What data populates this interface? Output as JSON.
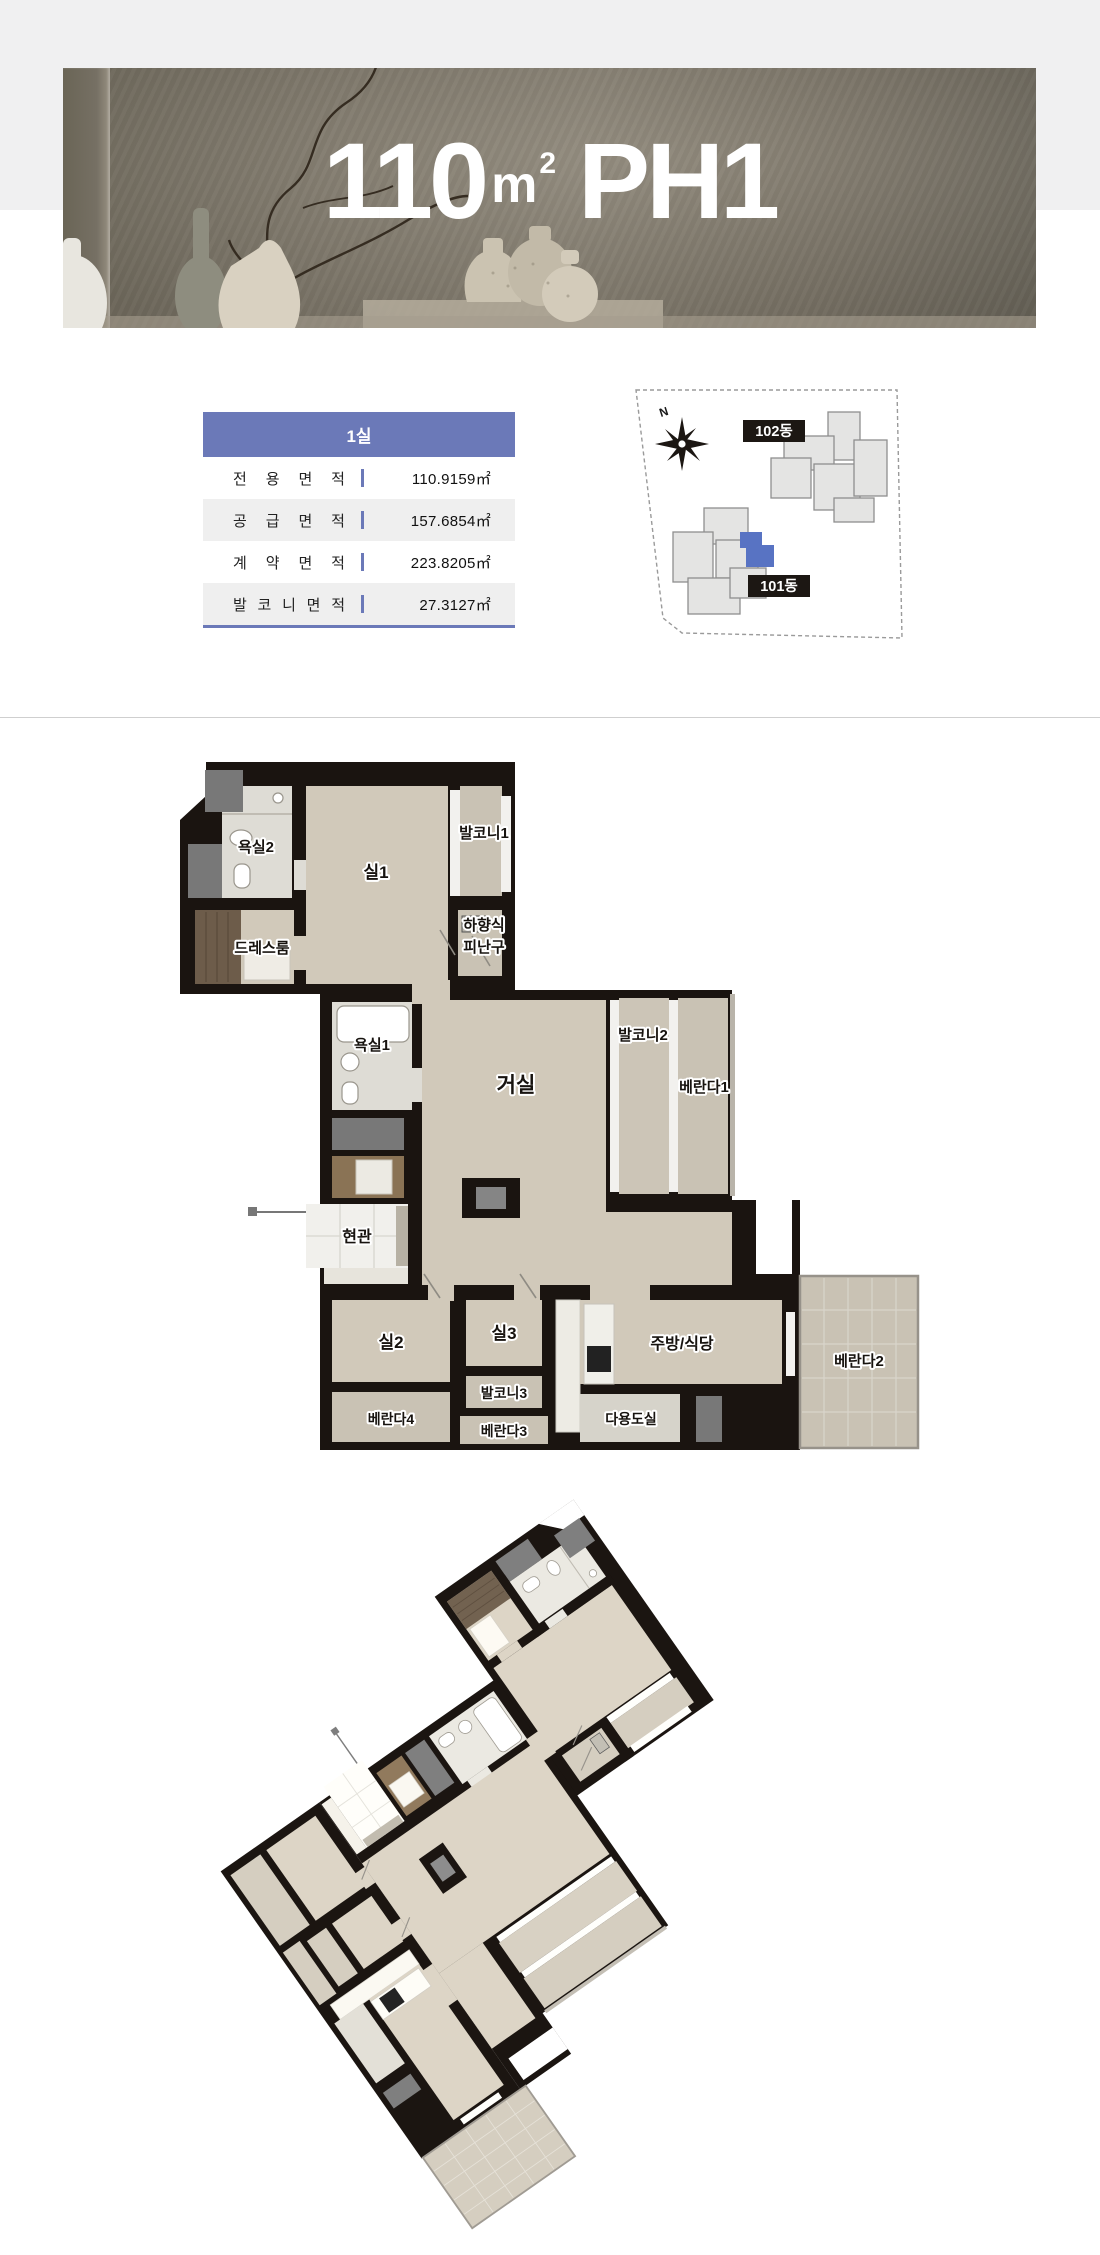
{
  "page": {
    "background": "#ffffff",
    "top_band_color": "#f0f0f1",
    "divider_color": "#cfcfcf"
  },
  "banner": {
    "area_value": "110",
    "area_unit_base": "m",
    "area_unit_exponent": "2",
    "unit_name": "PH1"
  },
  "info_table": {
    "header_label": "1실",
    "accent_color": "#6b79b8",
    "rows": [
      {
        "label": "전용면적",
        "value": "110.9159㎡"
      },
      {
        "label": "공급면적",
        "value": "157.6854㎡"
      },
      {
        "label": "계약면적",
        "value": "223.8205㎡"
      },
      {
        "label": "발코니면적",
        "value": "27.3127㎡"
      }
    ]
  },
  "site_plan": {
    "compass_label": "N",
    "building_labels": [
      "102동",
      "101동"
    ],
    "highlight_color": "#5873c3"
  },
  "floor_plan_2d": {
    "room_labels": [
      {
        "text": "욕실2",
        "x": 146,
        "y": 112,
        "s": 15
      },
      {
        "text": "실1",
        "x": 266,
        "y": 138,
        "s": 17
      },
      {
        "text": "발코니1",
        "x": 374,
        "y": 98,
        "s": 15
      },
      {
        "text": "하향식",
        "x": 374,
        "y": 190,
        "s": 15
      },
      {
        "text": "피난구",
        "x": 374,
        "y": 212,
        "s": 15
      },
      {
        "text": "드레스룸",
        "x": 152,
        "y": 213,
        "s": 15
      },
      {
        "text": "욕실1",
        "x": 262,
        "y": 310,
        "s": 15
      },
      {
        "text": "거실",
        "x": 406,
        "y": 352,
        "s": 21
      },
      {
        "text": "발코니2",
        "x": 533,
        "y": 300,
        "s": 15
      },
      {
        "text": "베란다1",
        "x": 594,
        "y": 352,
        "s": 15
      },
      {
        "text": "현관",
        "x": 247,
        "y": 502,
        "s": 16
      },
      {
        "text": "실2",
        "x": 281,
        "y": 608,
        "s": 17
      },
      {
        "text": "실3",
        "x": 394,
        "y": 599,
        "s": 17
      },
      {
        "text": "발코니3",
        "x": 394,
        "y": 658,
        "s": 14
      },
      {
        "text": "베란다4",
        "x": 281,
        "y": 684,
        "s": 14
      },
      {
        "text": "베란다3",
        "x": 394,
        "y": 696,
        "s": 14
      },
      {
        "text": "다용도실",
        "x": 521,
        "y": 684,
        "s": 14
      },
      {
        "text": "주방/식당",
        "x": 572,
        "y": 609,
        "s": 16
      },
      {
        "text": "베란다2",
        "x": 749,
        "y": 626,
        "s": 15
      }
    ]
  },
  "colors": {
    "wall": "#1a1410",
    "wood_floor": "#d1c9ba",
    "balcony_tile": "#c9c2b4",
    "bathroom_tile": "#dedcd5"
  }
}
